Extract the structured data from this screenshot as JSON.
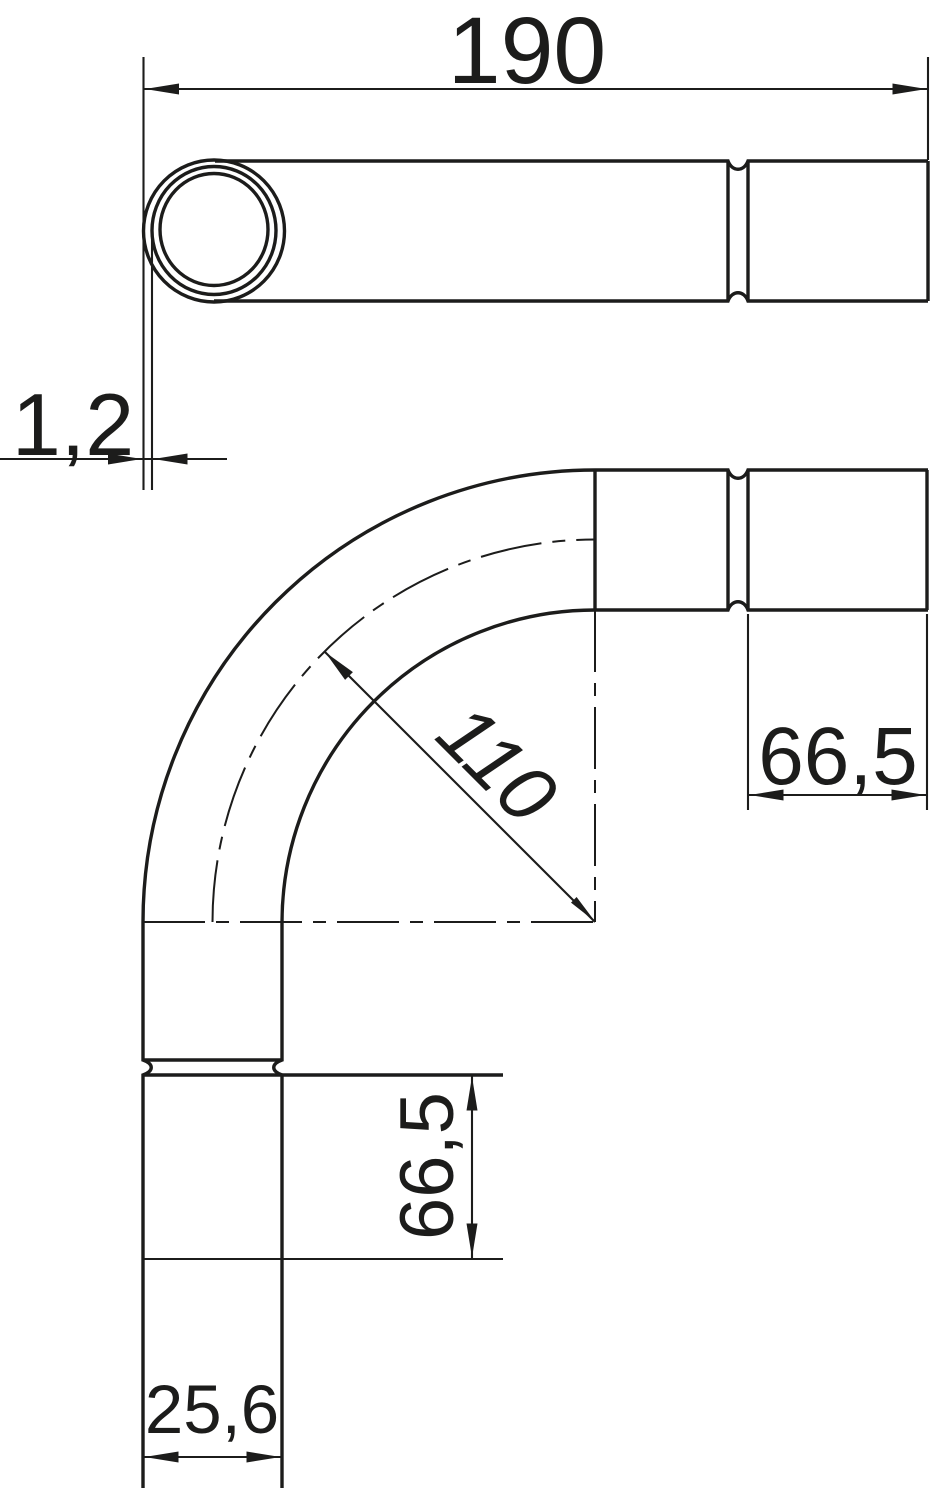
{
  "drawing": {
    "kind": "technical-dimension-drawing",
    "subject": "90-degree conduit pipe bend with socket, two orthographic views",
    "colors": {
      "line": "#1c1c1b",
      "background": "#ffffff"
    },
    "dims": {
      "overall_length": {
        "value": "190"
      },
      "wall_thickness": {
        "value": "1,2"
      },
      "bend_radius": {
        "value": "110"
      },
      "socket_length_right": {
        "value": "66,5"
      },
      "socket_length_left": {
        "value": "66,5"
      },
      "outer_diameter": {
        "value": "25,6"
      }
    }
  }
}
